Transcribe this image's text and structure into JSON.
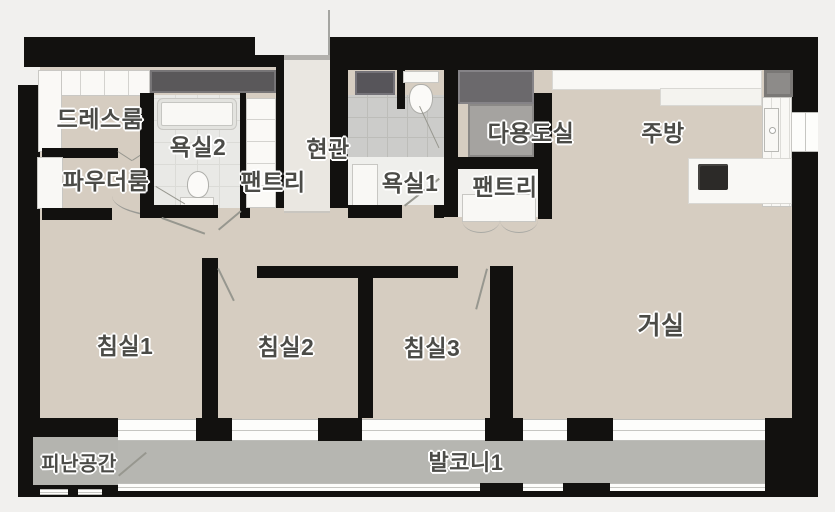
{
  "type": "apartment-floor-plan",
  "rooms": {
    "dress_room": "드레스룸",
    "powder_room": "파우더룸",
    "bathroom2": "욕실2",
    "pantry1": "팬트리",
    "entrance": "현관",
    "bathroom1": "욕실1",
    "utility_room": "다용도실",
    "pantry2": "팬트리",
    "kitchen": "주방",
    "bedroom1": "침실1",
    "bedroom2": "침실2",
    "bedroom3": "침실3",
    "living_room": "거실",
    "evacuation_space": "피난공간",
    "balcony1": "발코니1"
  },
  "colors": {
    "background": "#f1f0ee",
    "wall": "#12110f",
    "floor": "#d6cdc1",
    "entry_floor": "#eae7e1",
    "balcony_floor": "#b6b6b1",
    "bathroom_tile": "#e9e9e6",
    "shower_tile": "#ccccca",
    "fixture_white": "#f9f8f5",
    "appliance_gray": "#8d8b89",
    "storage_dark": "#5a585a",
    "label_text": "#4b4b47"
  }
}
